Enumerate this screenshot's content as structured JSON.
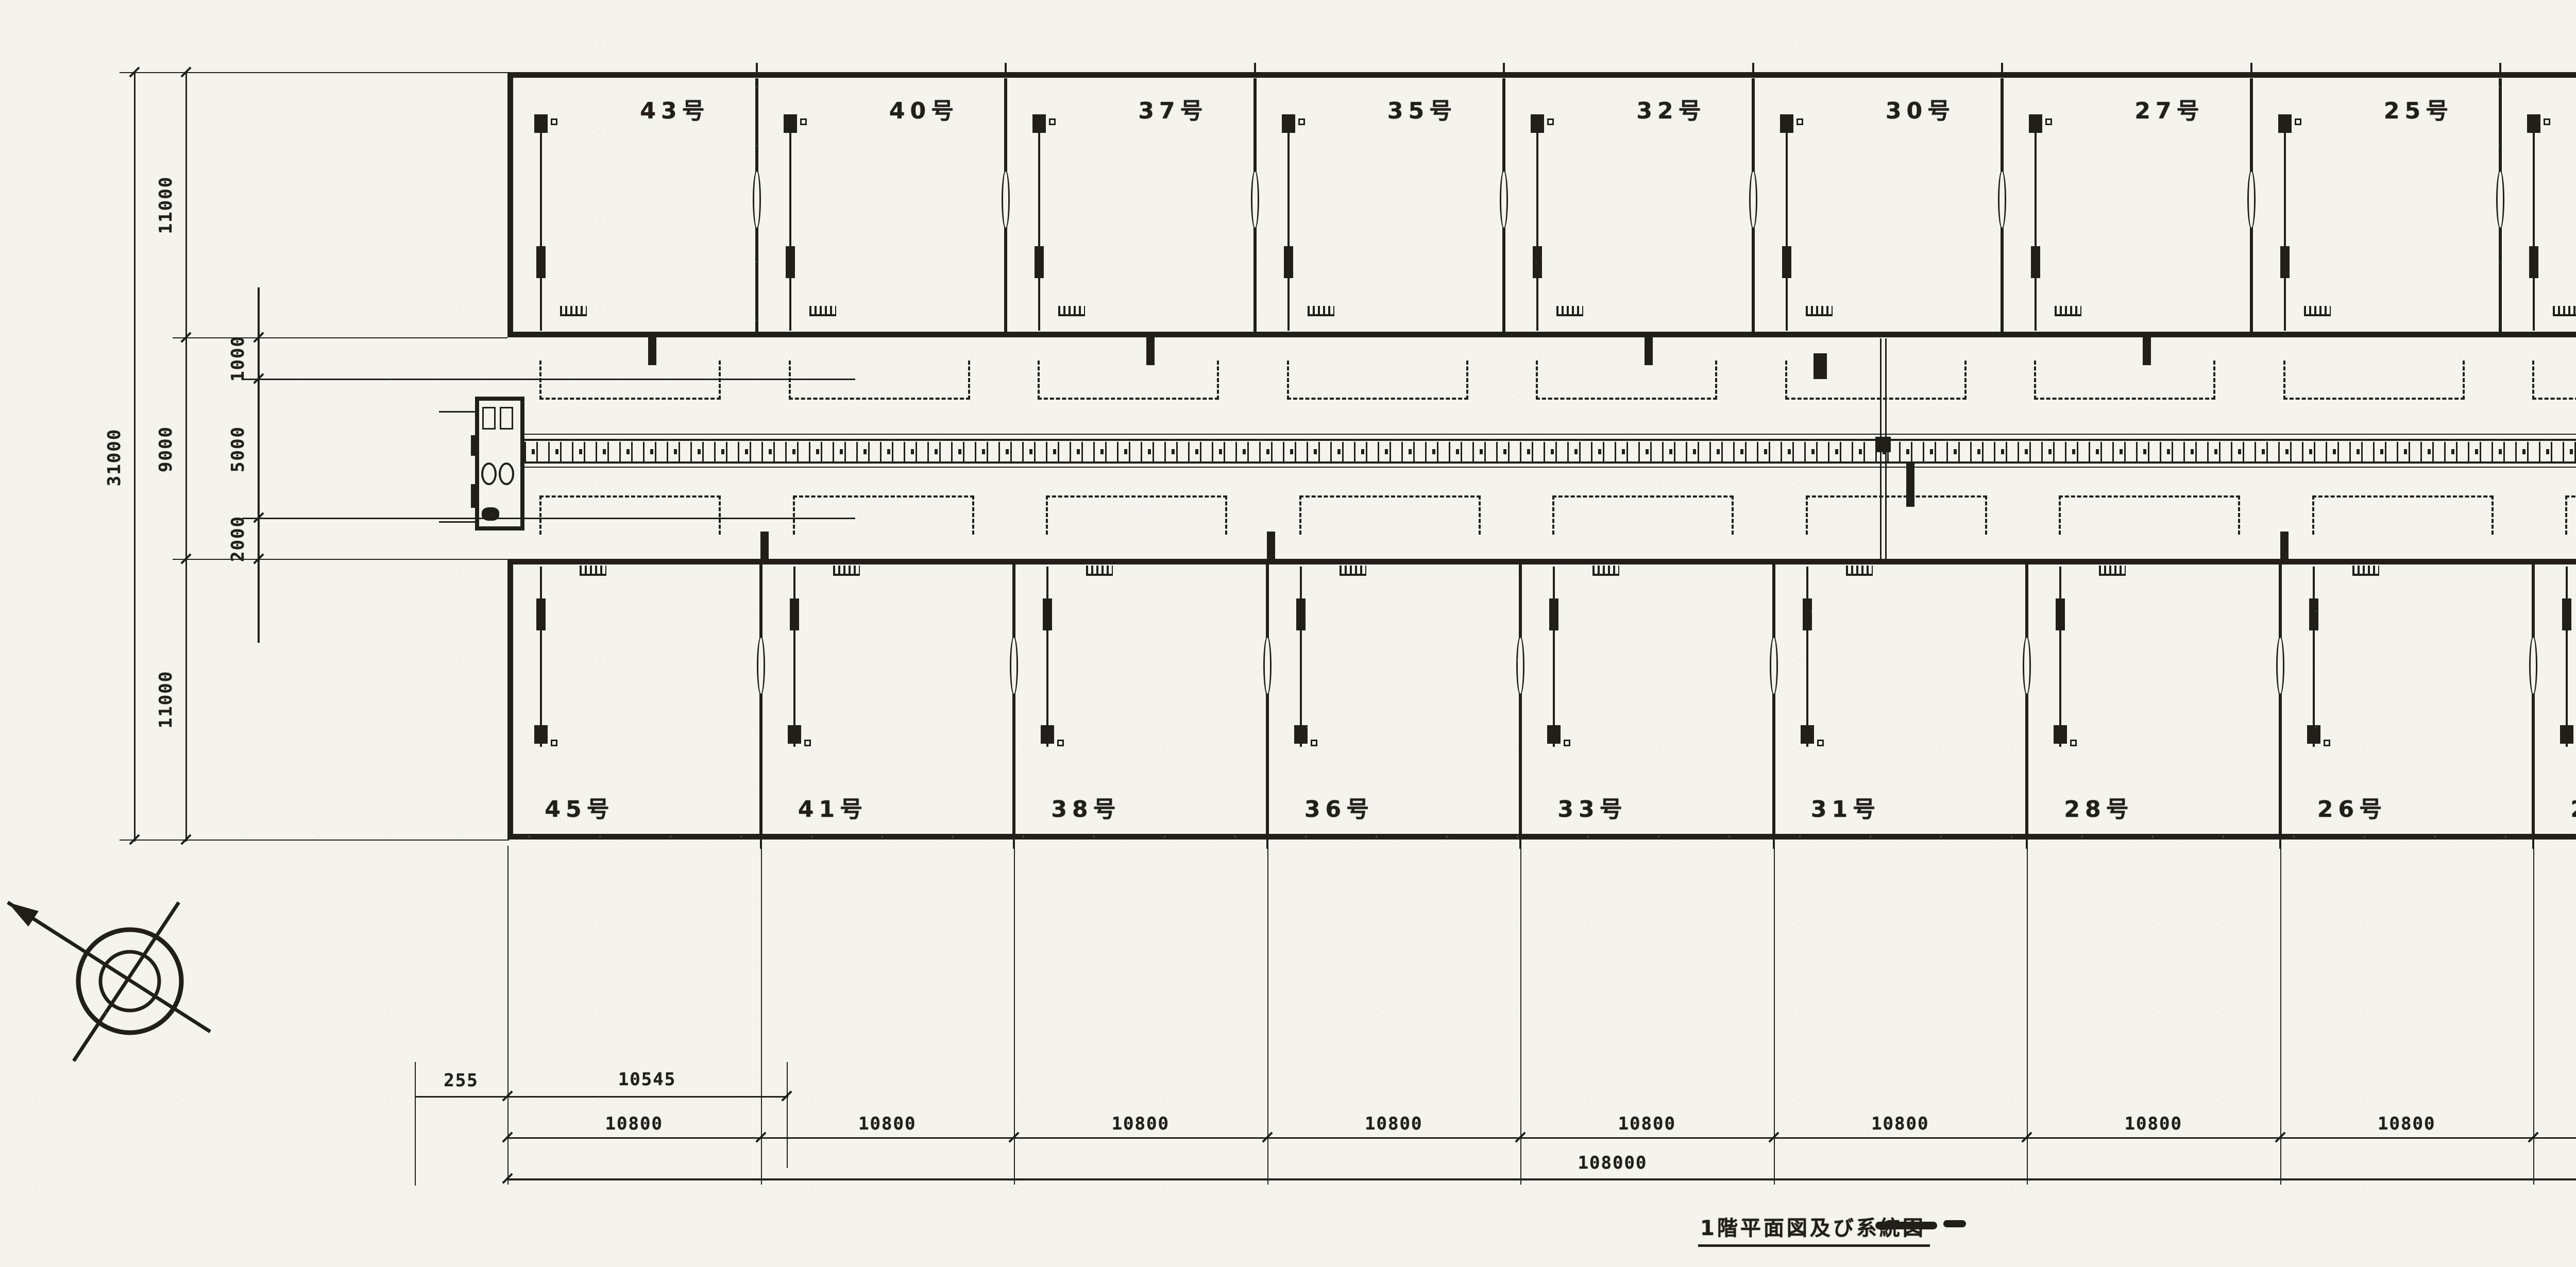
{
  "page": {
    "kind": "scanned architectural floor plan",
    "paper_color": "#f4f3ee",
    "ink_color": "#221f1b"
  },
  "title": {
    "text": "1階平面図及び系統図"
  },
  "units": {
    "top": [
      "43号",
      "40号",
      "37号",
      "35号",
      "32号",
      "30号",
      "27号",
      "25号",
      "22号",
      "20号"
    ],
    "bottom": [
      "45号",
      "41号",
      "38号",
      "36号",
      "33号",
      "31号",
      "28号",
      "26号",
      "23号",
      "21号"
    ]
  },
  "dimensions": {
    "left": {
      "overall": "31000",
      "chain": [
        "11000",
        "9000",
        "11000"
      ],
      "inner": [
        "1000",
        "5000",
        "2000"
      ]
    },
    "bottom": {
      "left_edge": [
        "255",
        "10545"
      ],
      "bays": [
        "10800",
        "10800",
        "10800",
        "10800",
        "10800",
        "10800",
        "10800",
        "10800",
        "10800",
        "10800"
      ],
      "overall": "108000",
      "right_edge": [
        "10545",
        "255"
      ],
      "right_offsets": [
        "3300",
        "1500"
      ]
    }
  }
}
